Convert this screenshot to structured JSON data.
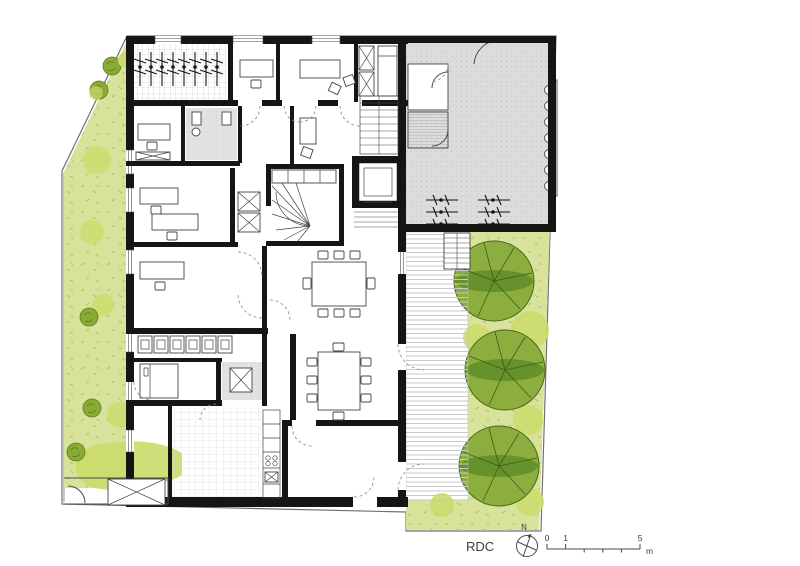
{
  "legend": {
    "floor_label": "RDC",
    "north_label": "N",
    "scale_ticks": [
      "0",
      "1",
      "5"
    ],
    "scale_unit": "m"
  },
  "icons": {
    "north_arrow": "compass-north-icon",
    "bike_rack": "bicycle-rack-icon",
    "tree": "tree-icon",
    "bush": "bush-icon"
  },
  "colors": {
    "wall": "#151515",
    "line": "#4a4a4a",
    "boundary": "#707070",
    "garden_light": "#d9e29b",
    "garden_blob": "#cbdc6a",
    "bush_dark": "#8aab33",
    "tree_fill": "#8cae3f",
    "tree_band": "#5e8a26",
    "tree_stroke": "#47691f",
    "court_gray": "#dcdcdc",
    "tile_line": "#c3c3c3",
    "deck_line": "#c9c9c9",
    "hatch_gray": "#e2e2e2",
    "legend_text": "#3c3c3c"
  }
}
